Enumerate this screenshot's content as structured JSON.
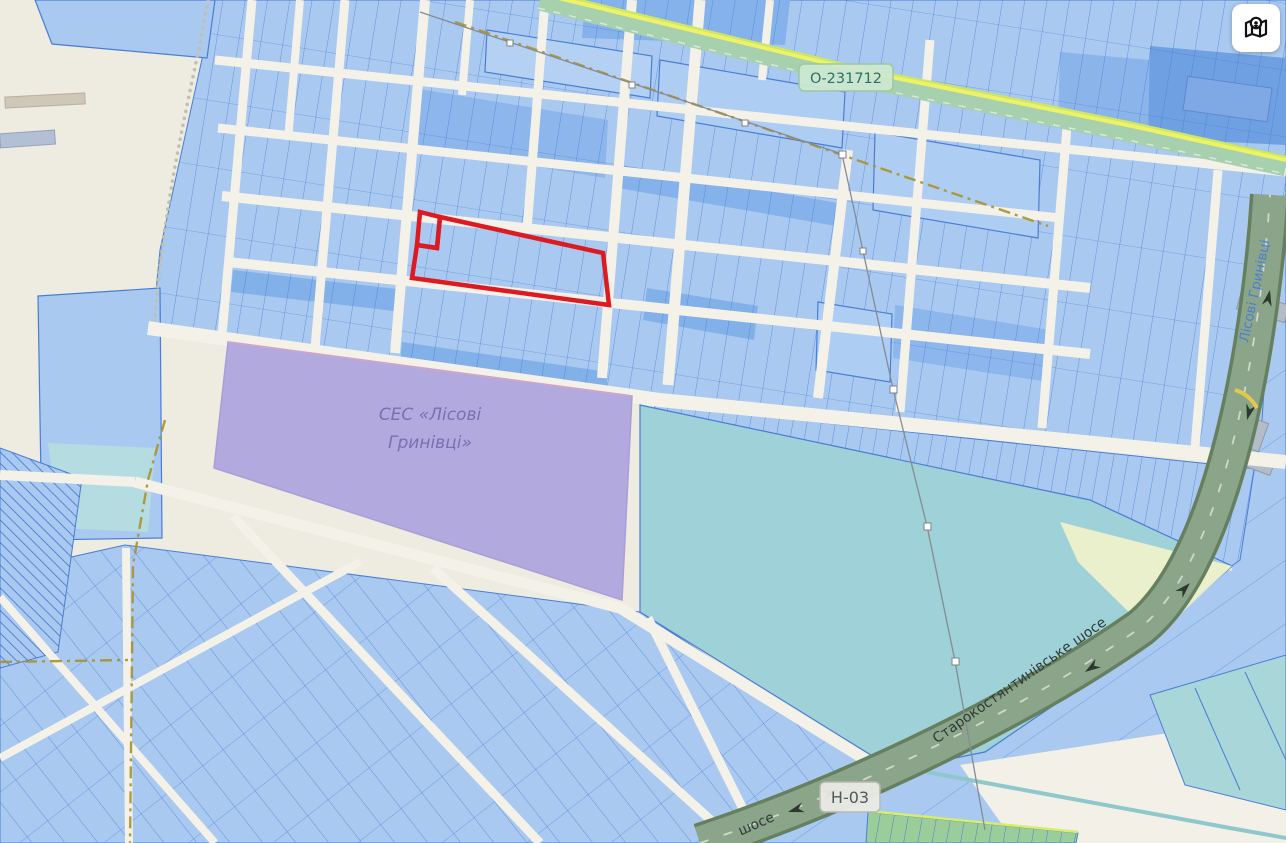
{
  "app": {
    "type": "cadastral-map-viewer",
    "controls": {
      "map_layers_button": {
        "icon": "map-location-icon"
      }
    }
  },
  "roads": {
    "regional_badge": "О-231712",
    "national_badge": "Н-03",
    "highway_label": "Старокостянтинівське шосе",
    "highway_label_partial": "шосе",
    "street_label": "Лісові Гринівці"
  },
  "areas": {
    "solar_station_label_line1": "СЕС «Лісові",
    "solar_station_label_line2": "Гринівці»"
  },
  "colors": {
    "background_beige": "#eeebe0",
    "road_fill": "#f4f1e8",
    "parcel_fill": "#a9c9f0",
    "parcel_fill_dark": "#82b0e8",
    "parcel_stroke": "#4a7dd4",
    "selection_red": "#dd1a21",
    "solar_area_fill": "#b2aade",
    "solar_label_text": "#7a6fb5",
    "reservoir_teal": "#9fd1d8",
    "pond_teal": "#b5dde1",
    "regional_road_green": "#a6d0ae",
    "regional_road_yellow_stripe": "#edf266",
    "highway_sage": "#8ba58b",
    "boundary_dash_olive": "#a8922d",
    "street_text_blue": "#4b7fd2",
    "badge_green_bg": "#cde8d0",
    "badge_gray_bg": "#ebebe5"
  }
}
